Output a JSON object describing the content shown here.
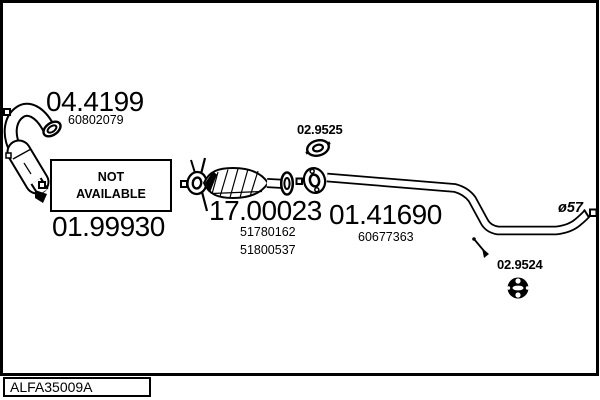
{
  "footer": {
    "reference": "ALFA35009A"
  },
  "colors": {
    "line": "#000000",
    "background": "#ffffff"
  },
  "parts": [
    {
      "name": "front-downpipe-catalyst",
      "code": "04.4199",
      "oe": "60802079"
    },
    {
      "name": "flex-section",
      "code": "01.99930",
      "status_line1": "NOT",
      "status_line2": "AVAILABLE"
    },
    {
      "name": "flange-gasket",
      "code": "02.9525"
    },
    {
      "name": "centre-silencer",
      "code": "17.00023",
      "oe1": "51780162",
      "oe2": "51800537"
    },
    {
      "name": "centre-pipe",
      "code": "01.41690",
      "oe": "60677363",
      "diameter": "ø57"
    },
    {
      "name": "rubber-hanger",
      "code": "02.9524"
    }
  ]
}
